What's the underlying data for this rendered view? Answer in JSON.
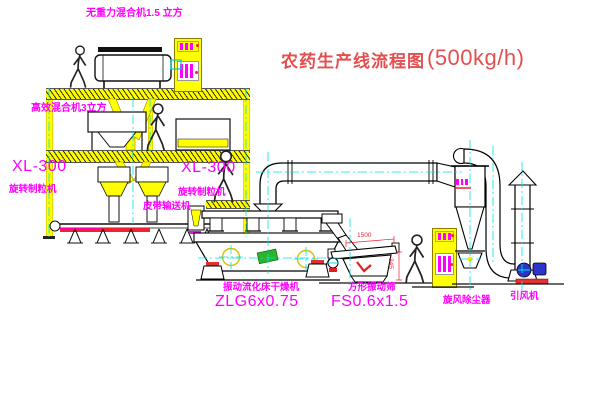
{
  "title": {
    "text": "农药生产线流程图",
    "capacity": "(500kg/h)"
  },
  "labels": {
    "gravity_free_mixer": "无重力混合机1.5 立方",
    "high_efficiency_mixer": "高效混合机3立方",
    "granulator_left": {
      "model": "XL-300",
      "name": "旋转制粒机"
    },
    "granulator_center": {
      "model": "XL-300",
      "name": "旋转制粒机"
    },
    "belt_conveyor": "皮带输送机",
    "fluid_bed_dryer": {
      "name": "振动流化床干燥机",
      "model": "ZLG6x0.75"
    },
    "vibrating_screen": {
      "name": "方形振动筛",
      "model": "FS0.6x1.5"
    },
    "cyclone_dust_collector": "旋风除尘器",
    "induced_draft_fan": "引风机"
  },
  "dimensions": {
    "screen_length": "1500",
    "screen_height": "345"
  },
  "colors": {
    "structure_yellow": "#ffff00",
    "label_magenta": "#ff00ff",
    "title_red": "#e34f4f",
    "centerline_cyan": "#00e5e5",
    "accent_red": "#ee2233",
    "fan_blue": "#2b35cc",
    "tag_green": "#2bb52b",
    "linework": "#000000",
    "background": "#ffffff"
  }
}
